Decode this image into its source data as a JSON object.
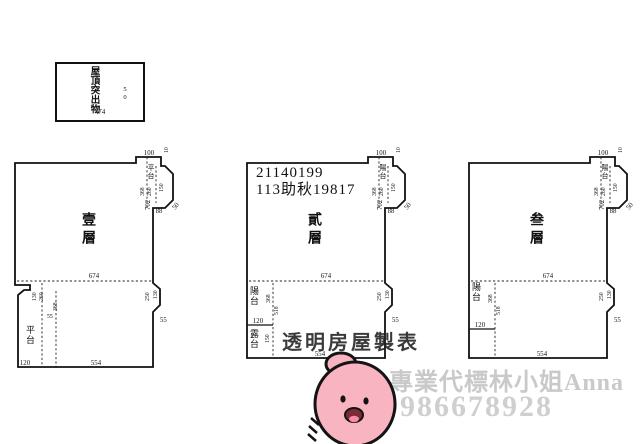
{
  "roof_box": {
    "label_vertical": "屋頂突出物",
    "width_dim": "474",
    "side_dim": "50"
  },
  "plans": [
    {
      "floor_label": "壹層",
      "top": {
        "width": "100",
        "step": "10"
      },
      "upper_right": {
        "area_label": "平台",
        "dim_a": "368",
        "dim_b": "260",
        "dim_c": "150",
        "wall": "702",
        "step": "88",
        "slant": "50"
      },
      "middle_width": "674",
      "lower_left": {
        "dim_a": "130",
        "dim_b": "260",
        "small": "55",
        "vert": "368",
        "area_label": "平台",
        "bottom_seg": "120"
      },
      "bottom_width": "554",
      "lower_right": {
        "dim_a": "250",
        "dim_b": "130",
        "slant": "55"
      }
    },
    {
      "floor_label": "貳層",
      "header_line1": "21140199",
      "header_line2": "113助秋19817",
      "top": {
        "width": "100",
        "step": "10"
      },
      "upper_right": {
        "area_label": "陽台",
        "dim_a": "368",
        "dim_b": "260",
        "dim_c": "150",
        "wall": "702",
        "step": "88",
        "slant": "50"
      },
      "middle_width": "674",
      "lower_left": {
        "area_label": "陽台",
        "vert1": "368",
        "vert2": "518",
        "bottom_seg": "120",
        "terrace_label": "露台",
        "terrace_dim": "150"
      },
      "bottom_width": "554",
      "lower_right": {
        "dim_a": "250",
        "dim_b": "130",
        "slant": "55"
      },
      "overlay_text": "透明房屋製表"
    },
    {
      "floor_label": "叁層",
      "top": {
        "width": "100",
        "step": "10"
      },
      "upper_right": {
        "area_label": "陽台",
        "dim_a": "368",
        "dim_b": "260",
        "dim_c": "150",
        "wall": "702",
        "step": "88",
        "slant": "50"
      },
      "middle_width": "674",
      "lower_left": {
        "area_label": "陽台",
        "vert1": "368",
        "vert2": "518",
        "bottom_seg": "120"
      },
      "bottom_width": "554",
      "lower_right": {
        "dim_a": "250",
        "dim_b": "130",
        "slant": "55"
      }
    }
  ],
  "watermark": {
    "line1": "專業代標林小姐Anna",
    "line2": "0986678928",
    "color": "#c9c9c9"
  },
  "sticker": {
    "name": "pink-hand-sticker",
    "fill": "#f8b5c1",
    "outline": "#141414"
  },
  "colors": {
    "line": "#111111",
    "background": "#ffffff"
  }
}
